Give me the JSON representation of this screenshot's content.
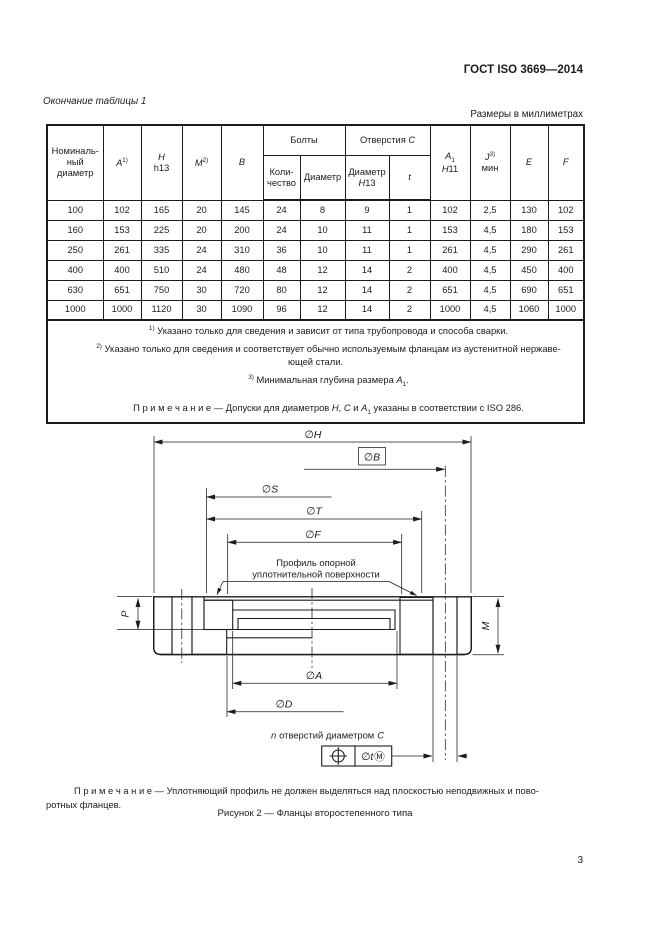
{
  "page": {
    "doc_code": "ГОСТ ISO 3669—2014",
    "table_continuation": "Окончание таблицы 1",
    "units_label": "Размеры в миллиметрах",
    "page_number": "3"
  },
  "table": {
    "header": {
      "nominal": "Номиналь-\nный\nдиаметр",
      "a": "*A*^{1)}",
      "h": "*H*\nh13",
      "m": "*M*^{2)}",
      "b": "*B*",
      "bolts_group": "Болты",
      "bolts_qty": "Коли-\nчество",
      "bolts_dia": "Диаметр",
      "holes_group": "Отверстия *C*",
      "holes_dia": "Диаметр\n*H*13",
      "holes_t": "*t*",
      "a1": "*A*_{1}\n*H*11",
      "j": "*J*^{3)}\nмин",
      "e": "*E*",
      "f": "*F*"
    },
    "rows": [
      [
        "100",
        "102",
        "165",
        "20",
        "145",
        "24",
        "8",
        "9",
        "1",
        "102",
        "2,5",
        "130",
        "102"
      ],
      [
        "160",
        "153",
        "225",
        "20",
        "200",
        "24",
        "10",
        "11",
        "1",
        "153",
        "4,5",
        "180",
        "153"
      ],
      [
        "250",
        "261",
        "335",
        "24",
        "310",
        "36",
        "10",
        "11",
        "1",
        "261",
        "4,5",
        "290",
        "261"
      ],
      [
        "400",
        "400",
        "510",
        "24",
        "480",
        "48",
        "12",
        "14",
        "2",
        "400",
        "4,5",
        "450",
        "400"
      ],
      [
        "630",
        "651",
        "750",
        "30",
        "720",
        "80",
        "12",
        "14",
        "2",
        "651",
        "4,5",
        "690",
        "651"
      ],
      [
        "1000",
        "1000",
        "1120",
        "30",
        "1090",
        "96",
        "12",
        "14",
        "2",
        "1000",
        "4,5",
        "1060",
        "1000"
      ]
    ],
    "footnotes": [
      "^{1)} Указано только для сведения и зависит от типа трубопровода и способа сварки.",
      "^{2)} Указано только для сведения и соответствует обычно используемым фланцам из аустенитной нержаве-\nющей стали.",
      "^{3)} Минимальная глубина размера *A*_{1}."
    ],
    "note": "П р и м е ч а н и е — Допуски для диаметров *H*, *C* и *A*_{1} указаны в соответствии с ISO 286."
  },
  "drawing": {
    "labels": {
      "h": "∅H",
      "b": "∅B",
      "s": "∅S",
      "t": "∅T",
      "f": "∅F",
      "a": "∅A",
      "d": "∅D",
      "p": "P",
      "m": "M"
    },
    "seal_note": {
      "line1": "Профиль опорной",
      "line2": "уплотнительной поверхности"
    },
    "holes_note": {
      "n": "n",
      "text": "отверстий диаметром",
      "c": "C"
    },
    "gdt": {
      "value": "∅t",
      "modifier": "Ⓜ"
    }
  },
  "bottom_note": "П р и м е ч а н и е — Уплотняющий профиль не должен выделяться над плоскостью неподвижных и пово-\nротных фланцев.",
  "figure_caption": "Рисунок 2 — Фланцы второстепенного типа"
}
